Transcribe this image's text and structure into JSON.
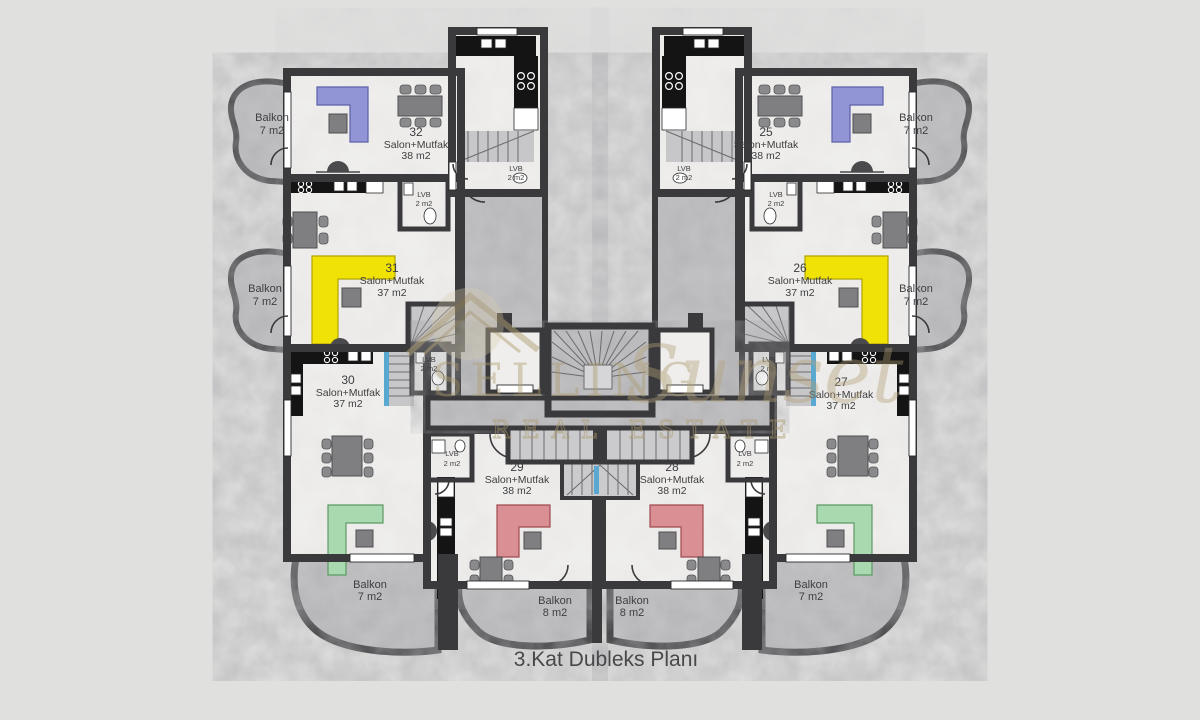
{
  "title": "3.Kat Dubleks Planı",
  "watermark": {
    "brand": "SELLING",
    "script": "Sunset",
    "tagline": "REAL ESTATE"
  },
  "units": [
    {
      "number": "32",
      "room": "Salon+Mutfak",
      "area": "38 m2"
    },
    {
      "number": "25",
      "room": "Salon+Mutfak",
      "area": "38 m2"
    },
    {
      "number": "31",
      "room": "Salon+Mutfak",
      "area": "37 m2"
    },
    {
      "number": "26",
      "room": "Salon+Mutfak",
      "area": "37 m2"
    },
    {
      "number": "30",
      "room": "Salon+Mutfak",
      "area": "37 m2"
    },
    {
      "number": "27",
      "room": "Salon+Mutfak",
      "area": "37 m2"
    },
    {
      "number": "29",
      "room": "Salon+Mutfak",
      "area": "38 m2"
    },
    {
      "number": "28",
      "room": "Salon+Mutfak",
      "area": "38 m2"
    }
  ],
  "balconies": [
    {
      "label": "Balkon",
      "area": "7 m2",
      "position": "top-left"
    },
    {
      "label": "Balkon",
      "area": "7 m2",
      "position": "top-right"
    },
    {
      "label": "Balkon",
      "area": "7 m2",
      "position": "middle-left"
    },
    {
      "label": "Balkon",
      "area": "7 m2",
      "position": "middle-right"
    },
    {
      "label": "Balkon",
      "area": "7 m2",
      "position": "bottom-left"
    },
    {
      "label": "Balkon",
      "area": "7 m2",
      "position": "bottom-right"
    },
    {
      "label": "Balkon",
      "area": "8 m2",
      "position": "bottom-center-left"
    },
    {
      "label": "Balkon",
      "area": "8 m2",
      "position": "bottom-center-right"
    }
  ],
  "wcs": [
    {
      "label": "LVB",
      "area": "2 m2",
      "unit": "32"
    },
    {
      "label": "LVB",
      "area": "2 m2",
      "unit": "25"
    },
    {
      "label": "LVB",
      "area": "2 m2",
      "unit": "31"
    },
    {
      "label": "LVB",
      "area": "2 m2",
      "unit": "26"
    },
    {
      "label": "LVB",
      "area": "2 m2",
      "unit": "30"
    },
    {
      "label": "LVB",
      "area": "2 m2",
      "unit": "27"
    },
    {
      "label": "LVB",
      "area": "2 m2",
      "unit": "29"
    },
    {
      "label": "LVB",
      "area": "2 m2",
      "unit": "28"
    }
  ],
  "colors": {
    "wall": "#3a3a3c",
    "floor": "#f1f0ee",
    "marble": "#c3c3c5",
    "counter": "#141414",
    "sofa_blue": "#9195d6",
    "sofa_yellow": "#f0e204",
    "sofa_green": "#a9d9ae",
    "sofa_red": "#d98f94",
    "stair_glass": "#58a8d2",
    "watermark_gold": "#b3a176",
    "label_text": "#3e3e40"
  }
}
